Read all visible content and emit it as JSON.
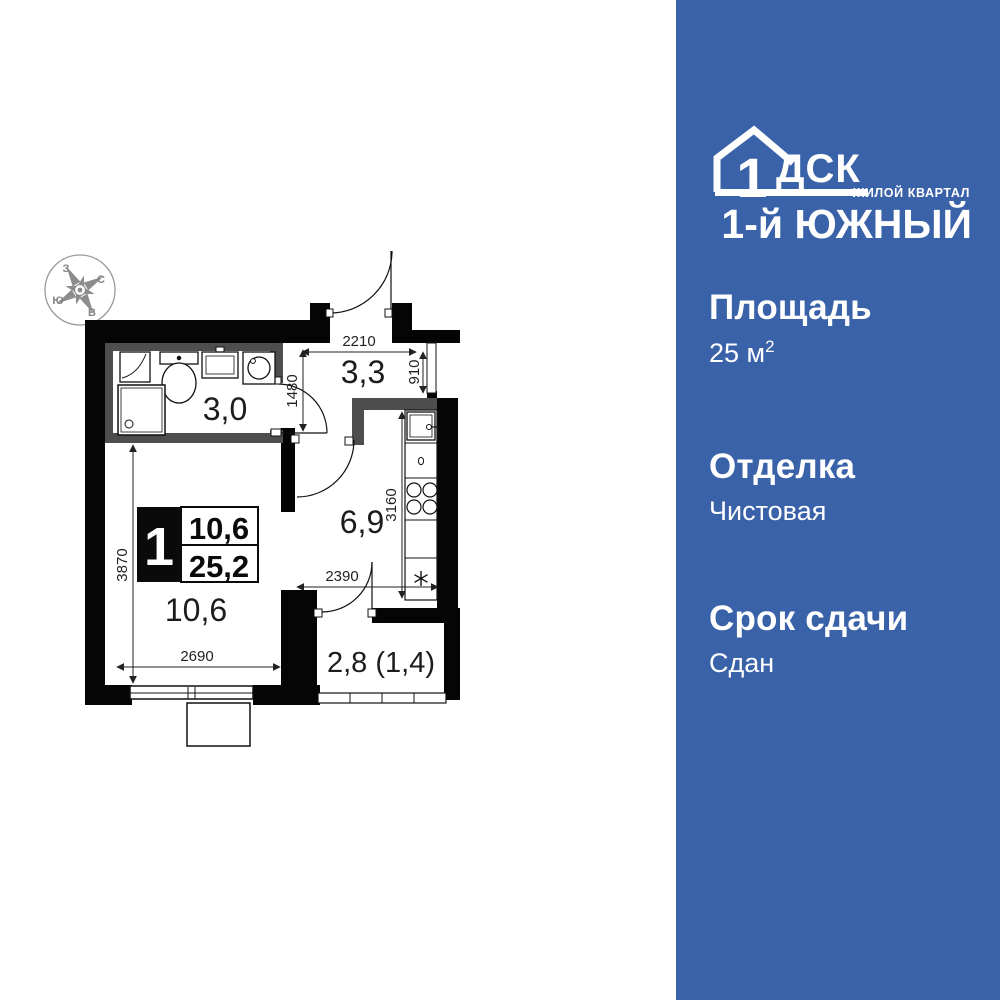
{
  "brand": {
    "logo_number": "1",
    "logo_letters": "ДСК",
    "tagline": "ЖИЛОЙ КВАРТАЛ",
    "project": "1-й ЮЖНЫЙ"
  },
  "panel": {
    "accent_color": "#3a62a8",
    "sections": [
      {
        "label": "Площадь",
        "value": "25 м",
        "value_sup": "2"
      },
      {
        "label": "Отделка",
        "value": "Чистовая"
      },
      {
        "label": "Срок сдачи",
        "value": "Сдан"
      }
    ]
  },
  "floorplan": {
    "compass": {
      "west": "З",
      "north": "С",
      "east": "В",
      "south": "Ю"
    },
    "rooms": {
      "bathroom": "3,0",
      "hallway": "3,3",
      "kitchen": "6,9",
      "living": "10,6",
      "balcony": "2,8 (1,4)"
    },
    "dimensions": {
      "hall_width": "2210",
      "hall_window": "910",
      "bath_wall": "1480",
      "kitchen_depth": "3160",
      "kitchen_width": "2390",
      "living_depth": "3870",
      "living_width": "2690"
    },
    "badge": {
      "room_count": "1",
      "living_area": "10,6",
      "total_area": "25,2"
    }
  }
}
